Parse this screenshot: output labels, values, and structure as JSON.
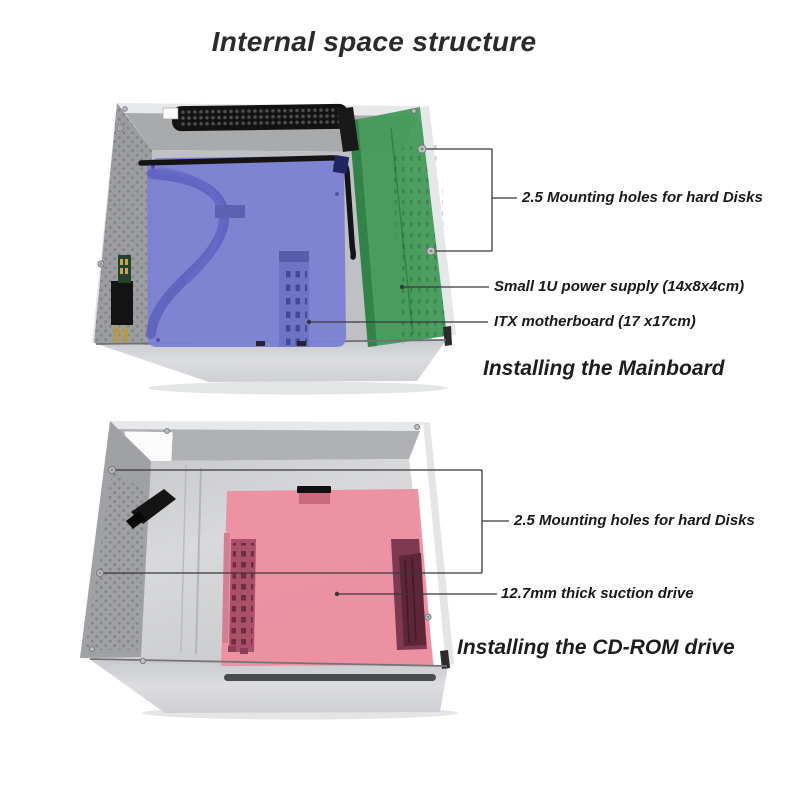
{
  "title": "Internal space structure",
  "colors": {
    "motherboard_highlight": "#7b80d2",
    "hdd_mount_highlight": "#439a58",
    "cdrom_highlight": "#ec8fa0",
    "leader_line": "#38383a",
    "case_metal": "#d6d7d9"
  },
  "sections": [
    {
      "id": "mainboard",
      "caption": "Installing the Mainboard",
      "labels": [
        "2.5 Mounting holes for hard Disks",
        "Small 1U power supply (14x8x4cm)",
        "ITX motherboard (17 x17cm)"
      ]
    },
    {
      "id": "cdrom",
      "caption": "Installing the CD-ROM drive",
      "labels": [
        "2.5 Mounting holes for hard Disks",
        "12.7mm thick suction drive"
      ]
    }
  ]
}
